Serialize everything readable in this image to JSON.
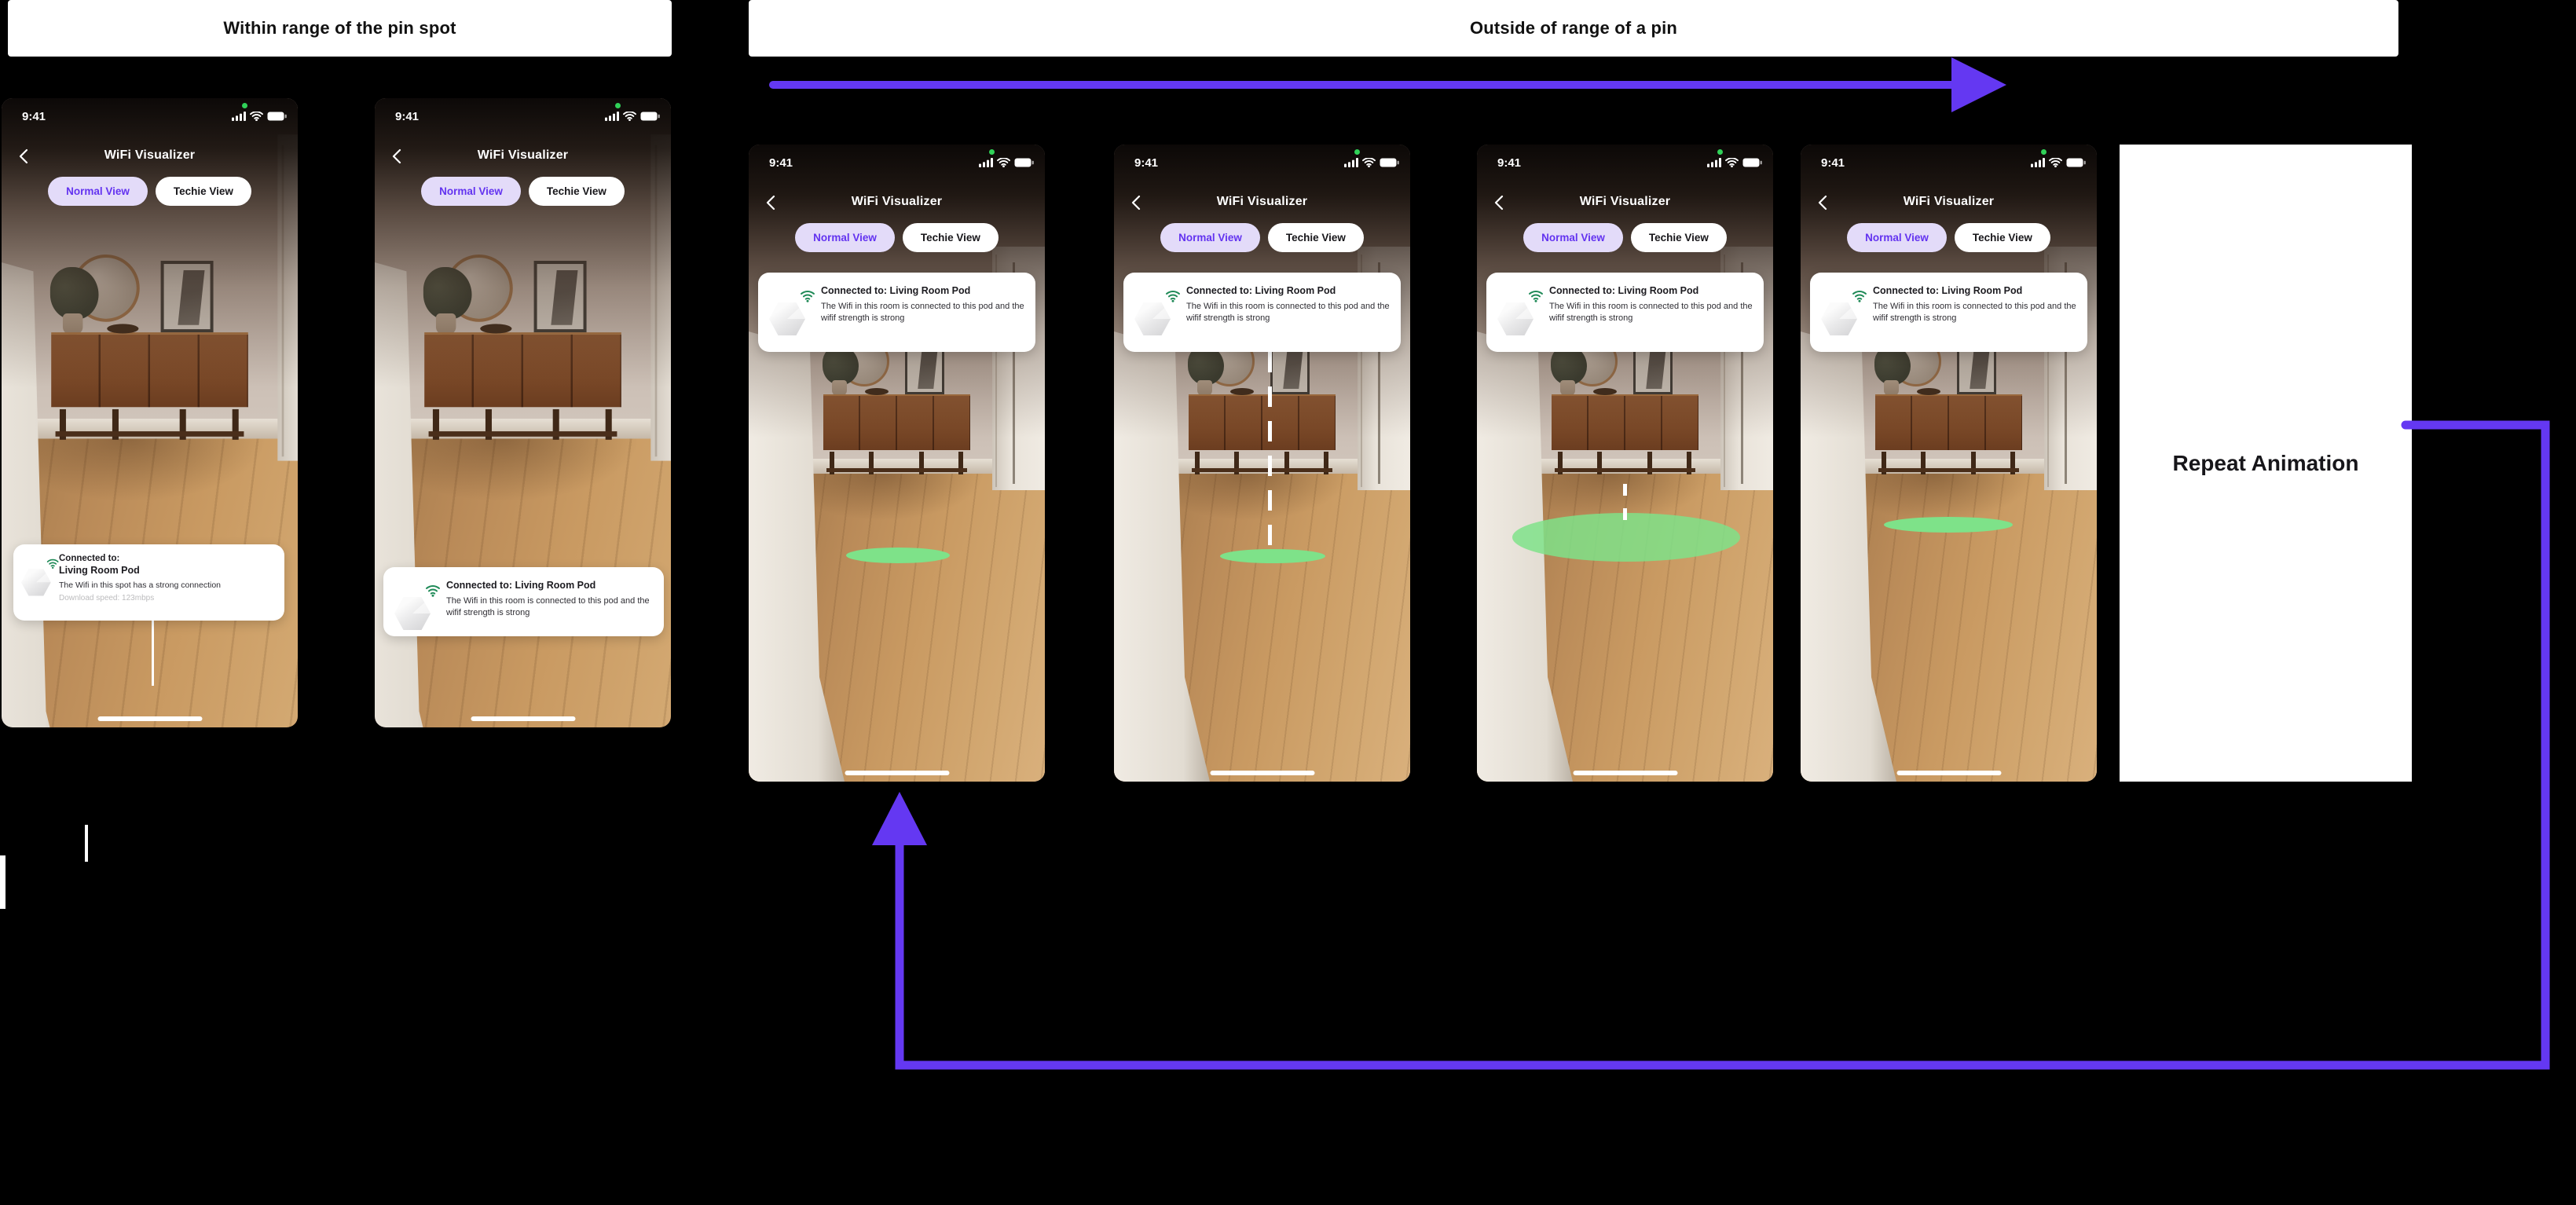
{
  "banners": {
    "within_range": "Within range of the pin spot",
    "outside_range": "Outside of range of a pin"
  },
  "flow": {
    "repeat_label": "Repeat Animation",
    "arrow_color": "#6438F2"
  },
  "colors": {
    "background": "#000000",
    "pin_spot_green": "#7EE289",
    "pod_wifi_green": "#1F8A57",
    "selected_tab_bg": "#E3DBF9",
    "selected_tab_text": "#6333F0",
    "status_dot_green": "#30D158",
    "card_bg": "#FFFFFF"
  },
  "phone_common": {
    "status_time": "9:41",
    "nav_title": "WiFi Visualizer",
    "tab_normal": "Normal View",
    "tab_techie": "Techie View",
    "icons": {
      "back": "chevron-left-icon",
      "cellular": "cellular-signal-icon",
      "wifi": "wifi-icon",
      "battery": "battery-icon",
      "pod": "hexagon-pod-icon",
      "pod_signal": "wifi-arcs-icon",
      "home": "home-indicator-bar"
    }
  },
  "phones": [
    {
      "card": {
        "title_line1": "Connected to:",
        "title_line2": "Living Room Pod",
        "body": "The Wifi in this spot has a strong connection",
        "meta": "Download speed: 123mbps"
      }
    },
    {
      "card": {
        "title": "Connected to: Living Room Pod",
        "body": "The Wifi in this room is connected to this pod and the wifif strength is strong"
      }
    },
    {
      "card": {
        "title": "Connected to: Living Room Pod",
        "body": "The Wifi in this room is connected to this pod and the wifif strength is strong"
      }
    },
    {
      "card": {
        "title": "Connected to: Living Room Pod",
        "body": "The Wifi in this room is connected to this pod and the wifif strength is strong"
      }
    },
    {
      "card": {
        "title": "Connected to: Living Room Pod",
        "body": "The Wifi in this room is connected to this pod and the wifif strength is strong"
      }
    },
    {
      "card": {
        "title": "Connected to: Living Room Pod",
        "body": "The Wifi in this room is connected to this pod and the wifif strength is strong"
      }
    }
  ]
}
